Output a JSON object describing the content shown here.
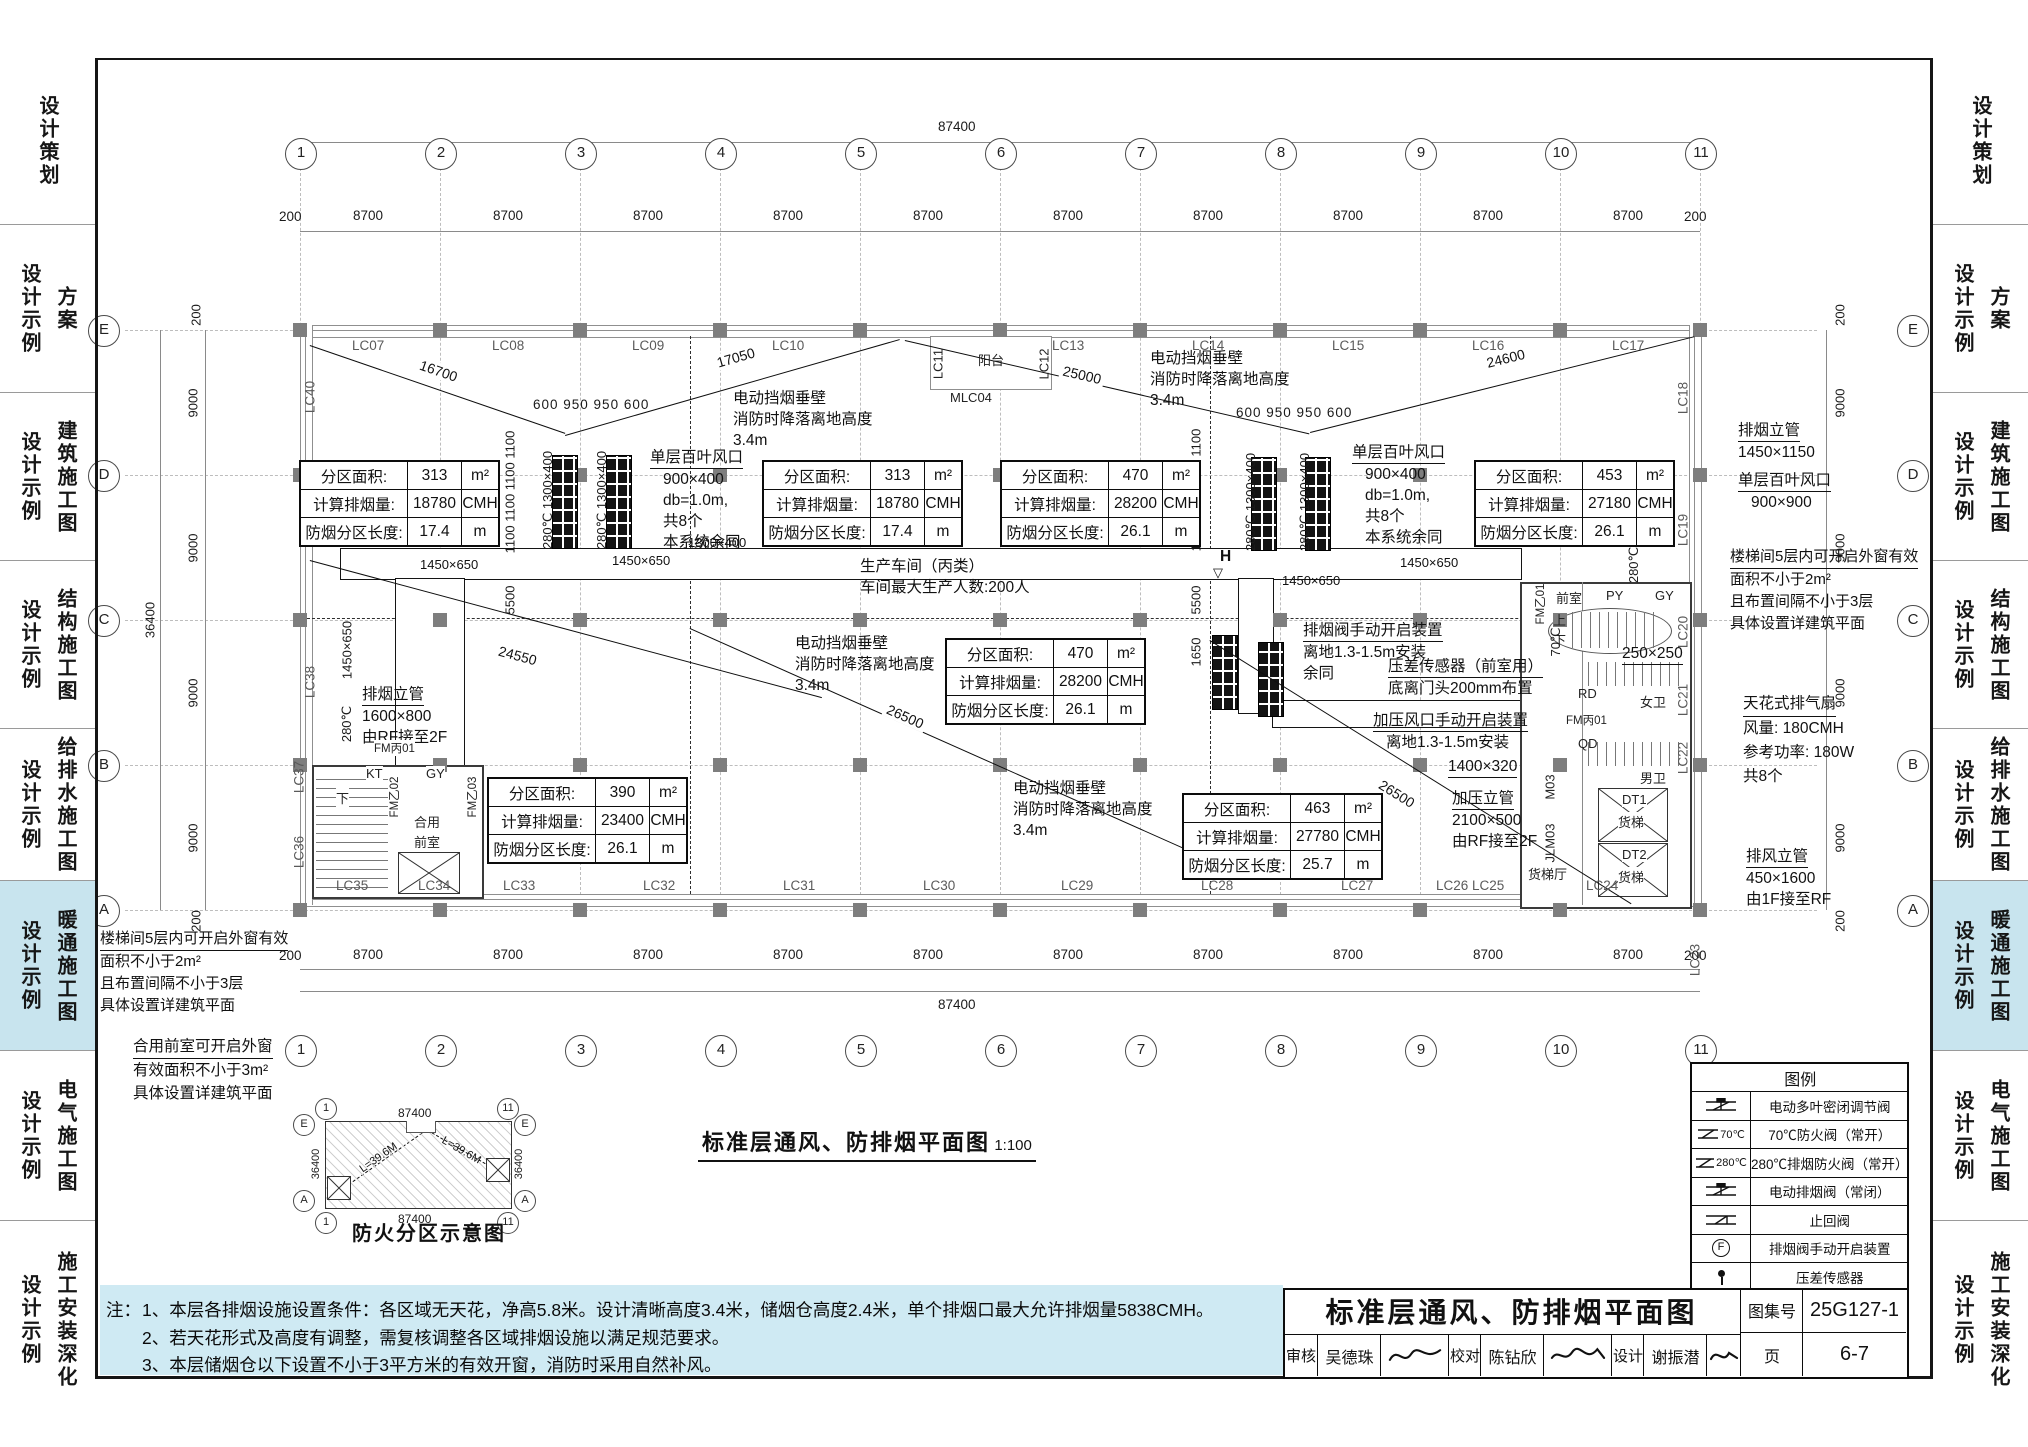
{
  "colors": {
    "highlight": "#c8e4ee",
    "notes_bg": "#cfeaf3"
  },
  "sidebar": {
    "active_index": 5,
    "items": [
      {
        "cat": "设计策划",
        "sub": ""
      },
      {
        "cat": "方案",
        "sub": "设计示例"
      },
      {
        "cat": "建筑施工图",
        "sub": "设计示例"
      },
      {
        "cat": "结构施工图",
        "sub": "设计示例"
      },
      {
        "cat": "给排水施工图",
        "sub": "设计示例"
      },
      {
        "cat": "暖通施工图",
        "sub": "设计示例"
      },
      {
        "cat": "电气施工图",
        "sub": "设计示例"
      },
      {
        "cat": "施工安装深化",
        "sub": "设计示例"
      }
    ]
  },
  "grid": {
    "cols": [
      "1",
      "2",
      "3",
      "4",
      "5",
      "6",
      "7",
      "8",
      "9",
      "10",
      "11"
    ],
    "rows": [
      "E",
      "D",
      "C",
      "B",
      "A"
    ],
    "bay_h": "8700",
    "bay_v": "9000",
    "end": "200",
    "overall_h": "87400",
    "overall_v": "36400"
  },
  "tables": {
    "labels": [
      "分区面积:",
      "计算排烟量:",
      "防烟分区长度:"
    ],
    "units": [
      "m²",
      "CMH",
      "m"
    ],
    "zones": [
      {
        "a": "313",
        "s": "18780",
        "l": "17.4"
      },
      {
        "a": "313",
        "s": "18780",
        "l": "17.4"
      },
      {
        "a": "470",
        "s": "28200",
        "l": "26.1"
      },
      {
        "a": "453",
        "s": "27180",
        "l": "26.1"
      },
      {
        "a": "470",
        "s": "28200",
        "l": "26.1"
      },
      {
        "a": "390",
        "s": "23400",
        "l": "26.1"
      },
      {
        "a": "463",
        "s": "27780",
        "l": "25.7"
      }
    ]
  },
  "ann": {
    "barrier": [
      "电动挡烟垂壁",
      "消防时降落离地高度",
      "3.4m"
    ],
    "louver400": [
      "单层百叶风口",
      "900×400",
      "db=1.0m,",
      "共8个",
      "本系统余同"
    ],
    "louver900": [
      "单层百叶风口",
      "900×900"
    ],
    "dim600": "600 950 950 600",
    "riser_smoke_r": [
      "排烟立管",
      "1450×1150"
    ],
    "stair_note": [
      "楼梯间5层内可开启外窗有效",
      "面积不小于2m²",
      "且布置间隔不小于3层",
      "具体设置详建筑平面"
    ],
    "fan": [
      "天花式排气扇",
      "风量: 180CMH",
      "参考功率: 180W",
      "共8个"
    ],
    "riser_exhaust": [
      "排风立管",
      "450×1600",
      "由1F接至RF"
    ],
    "riser_smoke_l": [
      "排烟立管",
      "1600×800",
      "由RF接至2F"
    ],
    "riser_press": [
      "加压立管",
      "2100×500",
      "由RF接至2F"
    ],
    "manual_smoke": [
      "排烟阀手动开启装置",
      "离地1.3-1.5m安装",
      "余同"
    ],
    "sensor": [
      "压差传感器（前室用）",
      "底离门头200mm布置"
    ],
    "manual_press": [
      "加压风口手动开启装置",
      "离地1.3-1.5m安装"
    ],
    "lobby_note": [
      "合用前室可开启外窗",
      "有效面积不小于3m²",
      "具体设置详建筑平面"
    ],
    "workshop": [
      "生产车间（丙类）",
      "车间最大生产人数:200人"
    ],
    "d1400": "1400×320",
    "d250": "250×250",
    "d1450": "1450×650",
    "d1300": "1300×400",
    "seg16700": "16700",
    "seg17050": "17050",
    "seg25000": "25000",
    "seg24600": "24600",
    "seg24550": "24550",
    "seg26500": "26500",
    "v1100x4": "1100 1100 1100 1100",
    "v5500": "5500",
    "v1650": "1650",
    "v280": "280℃",
    "v280_1300": "280℃  1300×400",
    "balcony": "阳台",
    "mlc": "MLC04",
    "hmark": "H",
    "tri": "▽"
  },
  "win": {
    "top": [
      "LC07",
      "LC08",
      "LC09",
      "LC10",
      "LC13",
      "LC14",
      "LC15",
      "LC16",
      "LC17"
    ],
    "balcony": [
      "LC11",
      "LC12"
    ],
    "right": [
      "LC18",
      "LC19",
      "LC20",
      "LC21",
      "LC22"
    ],
    "bottom": [
      "LC35",
      "LC34",
      "LC33",
      "LC32",
      "LC31",
      "LC30",
      "LC29",
      "LC28",
      "LC27",
      "LC26 LC25",
      "LC24",
      "LC23"
    ],
    "left": [
      "LC40",
      "LC38",
      "LC37",
      "LC36"
    ]
  },
  "rooms": {
    "front": "前室",
    "py": "PY",
    "gy": "GY",
    "wbath": "女卫",
    "mbath": "男卫",
    "rd": "RD",
    "qd": "QD",
    "m03": "M03",
    "jlm03": "JLM03",
    "fmb01": "FM丙01",
    "fmy01": "FM乙01",
    "fmy02": "FM乙02",
    "fmy03": "FM乙03",
    "kt": "KT",
    "shared1": "合用",
    "shared2": "前室",
    "lifthall": "货梯厅",
    "dt1": "DT1",
    "dt2": "DT2",
    "lift": "货梯",
    "up": "上",
    "down": "下",
    "v70": "70℃"
  },
  "legend": {
    "title": "图例",
    "items": [
      {
        "pre": "",
        "label": "电动多叶密闭调节阀",
        "sym": "motor-valve"
      },
      {
        "pre": "70℃",
        "label": "70℃防火阀（常开）",
        "sym": "fire-valve"
      },
      {
        "pre": "280℃",
        "label": "280℃排烟防火阀（常开）",
        "sym": "fire-valve"
      },
      {
        "pre": "",
        "label": "电动排烟阀（常闭）",
        "sym": "motor-valve"
      },
      {
        "pre": "",
        "label": "止回阀",
        "sym": "check-valve"
      },
      {
        "pre": "",
        "label": "排烟阀手动开启装置",
        "sym": "manual-device",
        "glyph": "F"
      },
      {
        "pre": "",
        "label": "压差传感器",
        "sym": "pressure-sensor"
      }
    ]
  },
  "titleblock": {
    "title": "标准层通风、防排烟平面图",
    "fields": [
      {
        "k": "审核",
        "v": "吴德珠"
      },
      {
        "k": "校对",
        "v": "陈钻欣"
      },
      {
        "k": "设计",
        "v": "谢振潜"
      }
    ],
    "atlas_k": "图集号",
    "atlas_v": "25G127-1",
    "page_k": "页",
    "page_v": "6-7"
  },
  "notes": {
    "prefix": "注：",
    "l1": "1、本层各排烟设施设置条件：各区域无天花，净高5.8米。设计清晰高度3.4米，储烟仓高度2.4米，单个排烟口最大允许排烟量5838CMH。",
    "l2": "2、若天花形式及高度有调整，需复核调整各区域排烟设施以满足规范要求。",
    "l3": "3、本层储烟仓以下设置不小于3平方米的有效开窗，消防时采用自然补风。"
  },
  "main_title": {
    "text": "标准层通风、防排烟平面图",
    "scale": "1:100"
  },
  "fire": {
    "title": "防火分区示意图",
    "overall_h": "87400",
    "overall_v": "36400",
    "diag": "L=39.6M",
    "c1": "1",
    "c11": "11",
    "rE": "E",
    "rA": "A"
  }
}
